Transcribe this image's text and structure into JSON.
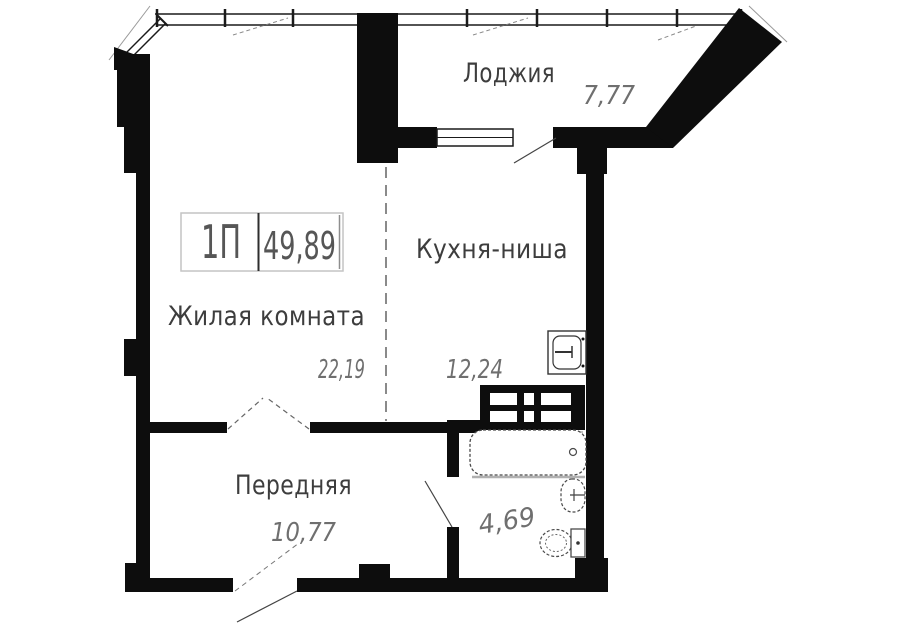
{
  "plan": {
    "apartment": {
      "type": "1П",
      "total_area": "49,89"
    },
    "rooms": {
      "loggia": {
        "name": "Лоджия",
        "area": "7,77"
      },
      "kitchen": {
        "name": "Кухня-ниша",
        "area": "12,24"
      },
      "living": {
        "name": "Жилая комната",
        "area": "22,19"
      },
      "hall": {
        "name": "Передняя",
        "area": "10,77"
      },
      "bathroom": {
        "area": "4,69"
      }
    },
    "icons": {
      "fixtures": [
        "bathtub-icon",
        "toilet-icon",
        "bathroom-sink-icon",
        "kitchen-sink-icon",
        "ventilation-shaft-icon"
      ]
    },
    "colors": {
      "wall": "#0d0d0d",
      "room_label": "#3d3d3d",
      "area_value": "#6f6f6f",
      "info_box_border": "#c4c4c4",
      "background": "#ffffff"
    }
  }
}
